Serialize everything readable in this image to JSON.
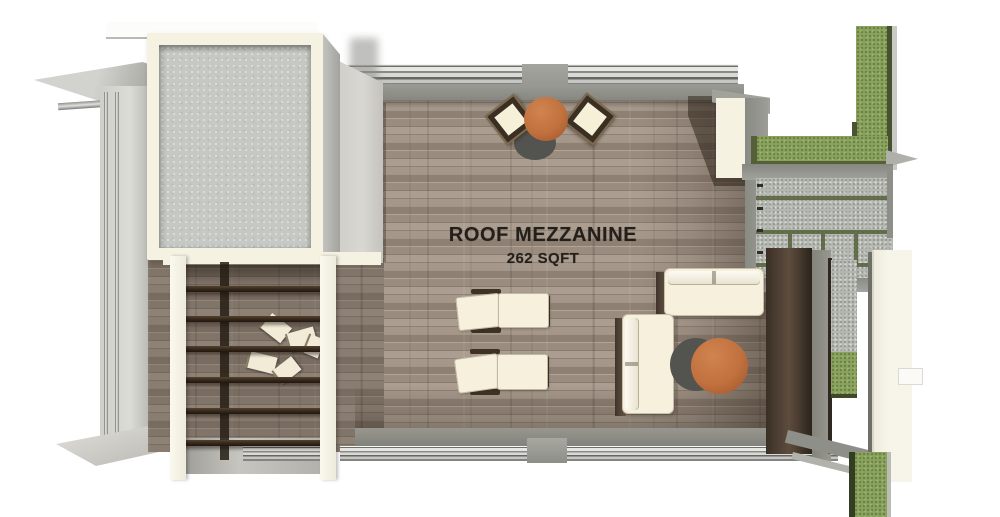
{
  "scene": {
    "type": "3D floor plan rendering, top-down view",
    "labels": {
      "room_name": "ROOF MEZZANINE",
      "room_area": "262 SQFT"
    }
  },
  "colors": {
    "background": "#ffffff",
    "deck_wood": "#9c8e82",
    "concrete_skylight": "#c6c8c3",
    "cream_frame": "#f5f2e2",
    "grass_green": "#8aa45c",
    "grass_edge": "#47512f",
    "gravel": "#b4b7b0",
    "wall_gray": "#8f8f89",
    "light_wall": "#d8d7d1",
    "pergola_slat": "#3a2c1d",
    "table_orange": "#c0713d",
    "cushion_cream": "#f6f0dc",
    "chair_frame": "#3a2f22",
    "shadow_wood": "#3c3127",
    "label_text": "#241f19"
  }
}
